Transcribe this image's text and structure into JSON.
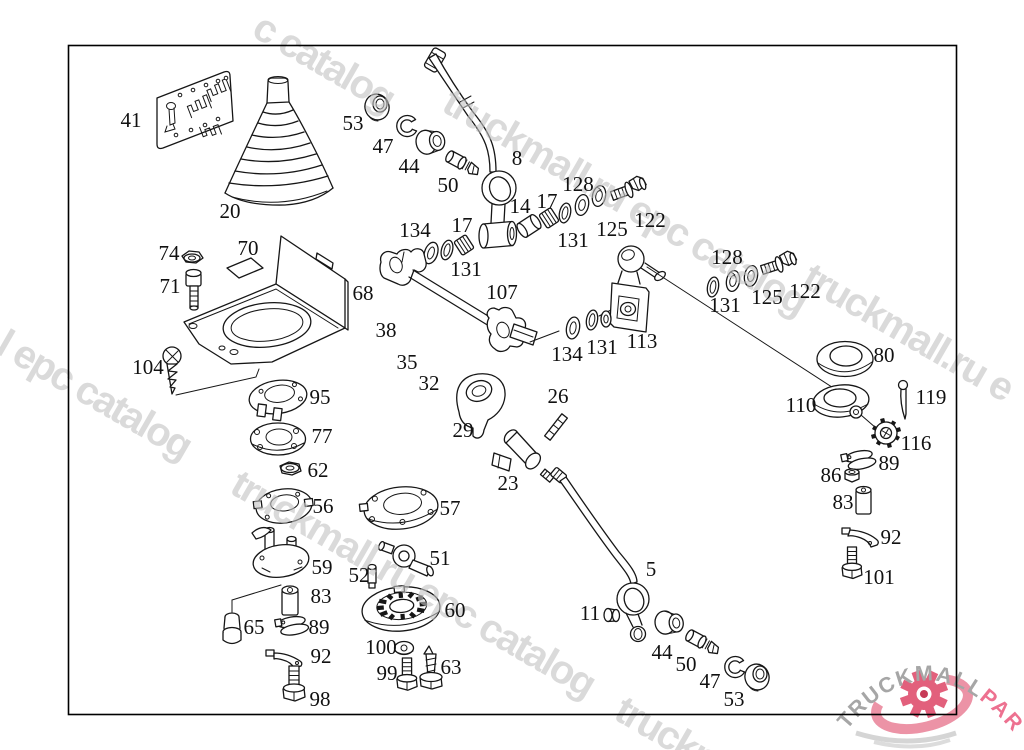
{
  "watermark": {
    "color": "#c3c3c3",
    "angle_deg": 30,
    "items": [
      {
        "text": "c catalog",
        "x": 250,
        "y": 35
      },
      {
        "text": "truckmall.ru epc catalog",
        "x": 440,
        "y": 110
      },
      {
        "text": "l epc catalog",
        "x": -6,
        "y": 352
      },
      {
        "text": "truckmall.ru e",
        "x": 800,
        "y": 285
      },
      {
        "text": "truckmall.ru epc catalog",
        "x": 228,
        "y": 492
      },
      {
        "text": "truckm",
        "x": 612,
        "y": 718
      }
    ]
  },
  "logo": {
    "gray_text": "TRUCKMALL",
    "pink_text": "PARTS",
    "gray_color": "#a6a6a6",
    "pink_color": "#ed7190",
    "gear_color": "#e2607c",
    "gear_center_color": "#c73a57",
    "swoosh_color": "#ec93a6",
    "shadow_color": "#d5d5d5"
  },
  "diagram": {
    "border_color": "#000000",
    "line_color": "#161616",
    "label_color": "#111111",
    "labels": [
      {
        "id": "41",
        "x": 131,
        "y": 127
      },
      {
        "id": "20",
        "x": 230,
        "y": 218
      },
      {
        "id": "53",
        "x": 353,
        "y": 130
      },
      {
        "id": "47",
        "x": 383,
        "y": 153
      },
      {
        "id": "44",
        "x": 409,
        "y": 173
      },
      {
        "id": "50",
        "x": 448,
        "y": 192
      },
      {
        "id": "8",
        "x": 517,
        "y": 165
      },
      {
        "id": "134",
        "x": 415,
        "y": 237
      },
      {
        "id": "17",
        "x": 462,
        "y": 232
      },
      {
        "id": "131",
        "x": 466,
        "y": 276
      },
      {
        "id": "14",
        "x": 520,
        "y": 213
      },
      {
        "id": "17",
        "x": 547,
        "y": 208
      },
      {
        "id": "128",
        "x": 578,
        "y": 191
      },
      {
        "id": "131",
        "x": 573,
        "y": 247
      },
      {
        "id": "125",
        "x": 612,
        "y": 236
      },
      {
        "id": "122",
        "x": 650,
        "y": 227
      },
      {
        "id": "107",
        "x": 502,
        "y": 299
      },
      {
        "id": "128",
        "x": 727,
        "y": 264
      },
      {
        "id": "131",
        "x": 725,
        "y": 312
      },
      {
        "id": "125",
        "x": 767,
        "y": 304
      },
      {
        "id": "122",
        "x": 805,
        "y": 298
      },
      {
        "id": "113",
        "x": 642,
        "y": 348
      },
      {
        "id": "134",
        "x": 567,
        "y": 361
      },
      {
        "id": "131",
        "x": 602,
        "y": 354
      },
      {
        "id": "80",
        "x": 884,
        "y": 362
      },
      {
        "id": "110",
        "x": 801,
        "y": 412
      },
      {
        "id": "119",
        "x": 931,
        "y": 404
      },
      {
        "id": "116",
        "x": 916,
        "y": 450
      },
      {
        "id": "89",
        "x": 889,
        "y": 470
      },
      {
        "id": "86",
        "x": 831,
        "y": 482
      },
      {
        "id": "83",
        "x": 843,
        "y": 509
      },
      {
        "id": "92",
        "x": 891,
        "y": 544
      },
      {
        "id": "101",
        "x": 879,
        "y": 584
      },
      {
        "id": "74",
        "x": 169,
        "y": 260
      },
      {
        "id": "71",
        "x": 170,
        "y": 293
      },
      {
        "id": "70",
        "x": 248,
        "y": 255
      },
      {
        "id": "68",
        "x": 363,
        "y": 300
      },
      {
        "id": "104",
        "x": 148,
        "y": 374
      },
      {
        "id": "95",
        "x": 320,
        "y": 404
      },
      {
        "id": "77",
        "x": 322,
        "y": 443
      },
      {
        "id": "62",
        "x": 318,
        "y": 477
      },
      {
        "id": "56",
        "x": 323,
        "y": 513
      },
      {
        "id": "59",
        "x": 322,
        "y": 574
      },
      {
        "id": "83",
        "x": 321,
        "y": 603
      },
      {
        "id": "65",
        "x": 254,
        "y": 634
      },
      {
        "id": "89",
        "x": 319,
        "y": 634
      },
      {
        "id": "92",
        "x": 321,
        "y": 663
      },
      {
        "id": "98",
        "x": 320,
        "y": 706
      },
      {
        "id": "38",
        "x": 386,
        "y": 337
      },
      {
        "id": "35",
        "x": 407,
        "y": 369
      },
      {
        "id": "32",
        "x": 429,
        "y": 390
      },
      {
        "id": "29",
        "x": 463,
        "y": 437
      },
      {
        "id": "26",
        "x": 558,
        "y": 403
      },
      {
        "id": "23",
        "x": 508,
        "y": 490
      },
      {
        "id": "57",
        "x": 450,
        "y": 515
      },
      {
        "id": "51",
        "x": 440,
        "y": 565
      },
      {
        "id": "52",
        "x": 359,
        "y": 582
      },
      {
        "id": "60",
        "x": 455,
        "y": 617
      },
      {
        "id": "100",
        "x": 381,
        "y": 654
      },
      {
        "id": "99",
        "x": 387,
        "y": 680
      },
      {
        "id": "63",
        "x": 451,
        "y": 674
      },
      {
        "id": "5",
        "x": 651,
        "y": 576
      },
      {
        "id": "11",
        "x": 590,
        "y": 620
      },
      {
        "id": "44",
        "x": 662,
        "y": 659
      },
      {
        "id": "50",
        "x": 686,
        "y": 671
      },
      {
        "id": "47",
        "x": 710,
        "y": 688
      },
      {
        "id": "53",
        "x": 734,
        "y": 706
      }
    ]
  }
}
